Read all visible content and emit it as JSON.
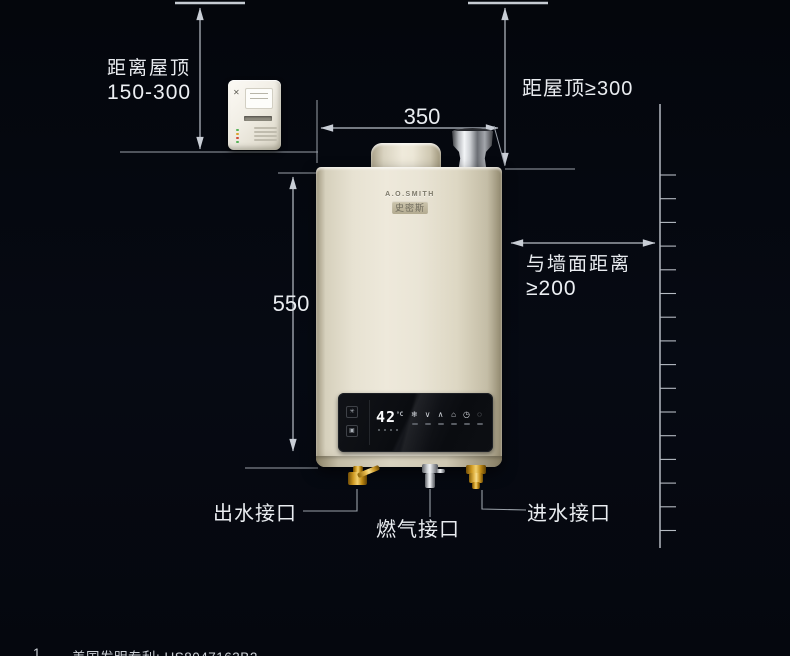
{
  "colors": {
    "background": "#05080f",
    "dimension_line": "#c3c8d0",
    "annotation_text": "#e9ecf0",
    "heater_champagne": "#e9e4d4",
    "panel_black": "#0b0d11",
    "brass": "#d9a42c",
    "chrome": "#d6d9dd",
    "alarm_white": "#f2efe6"
  },
  "annotations": {
    "roof_left": {
      "line1": "距离屋顶",
      "line2": "150-300"
    },
    "roof_right": {
      "label": "距屋顶≥300"
    },
    "width": {
      "label": "350"
    },
    "height": {
      "label": "550"
    },
    "wall": {
      "line1": "与墙面距离",
      "line2": "≥200"
    },
    "ports": {
      "outlet": "出水接口",
      "gas": "燃气接口",
      "inlet": "进水接口"
    }
  },
  "heater": {
    "brand_line1": "A.O.SMITH",
    "brand_line2": "史密斯",
    "panel": {
      "temperature": "42",
      "unit": "°C",
      "left_buttons": [
        {
          "name": "power-icon",
          "glyph": "✳"
        },
        {
          "name": "mode-icon",
          "glyph": "▣"
        }
      ],
      "icons": [
        {
          "name": "snow-icon",
          "glyph": "❄"
        },
        {
          "name": "down-arrow-icon",
          "glyph": "∨"
        },
        {
          "name": "up-arrow-icon",
          "glyph": "∧"
        },
        {
          "name": "shower-icon",
          "glyph": "⌂"
        },
        {
          "name": "timer-icon",
          "glyph": "◷"
        },
        {
          "name": "ring-icon",
          "glyph": "◌"
        }
      ]
    }
  },
  "ruler": {
    "tick_count": 16
  },
  "footnote": {
    "index": "1",
    "text": "美国发明专利: US8047163B2"
  }
}
